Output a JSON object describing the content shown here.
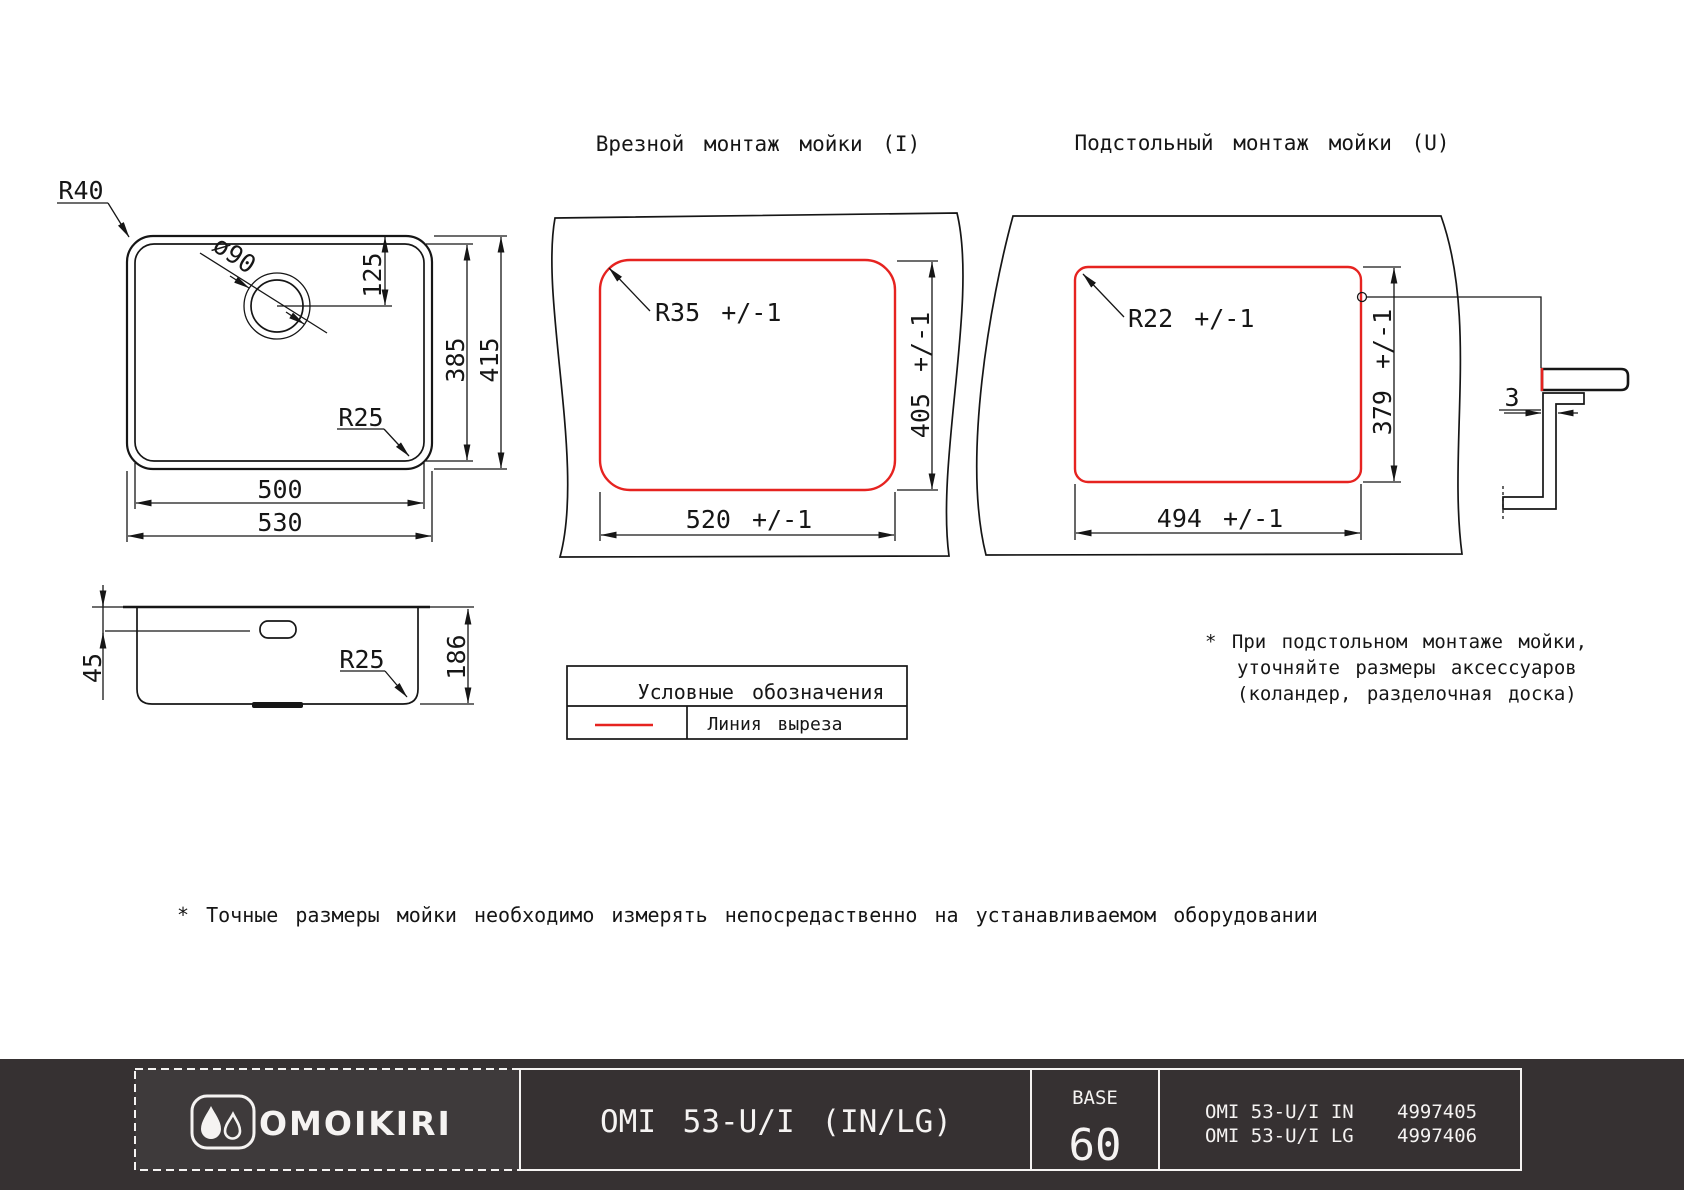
{
  "colors": {
    "cut_line_red": "#e62320",
    "drawing_line": "#161616",
    "footer_bar_bg": "#363132",
    "footer_logo_cell_bg": "#3e3a3b",
    "footer_text": "#f5f3f2"
  },
  "titles": {
    "inset_mount": "Врезной монтаж мойки (I)",
    "under_mount": "Подстольный монтаж мойки (U)"
  },
  "top_view": {
    "radius_outer": "R40",
    "drain_diameter": "ø90",
    "drain_offset": "125",
    "bowl_height": "385",
    "overall_height": "415",
    "radius_bowl": "R25",
    "bowl_width": "500",
    "overall_width": "530"
  },
  "side_view": {
    "overflow_offset": "45",
    "depth": "186",
    "bottom_radius": "R25"
  },
  "inset_view": {
    "corner_radius": "R35 +/-1",
    "cutout_height": "405 +/-1",
    "cutout_width": "520 +/-1"
  },
  "under_view": {
    "corner_radius": "R22 +/-1",
    "cutout_height": "379 +/-1",
    "cutout_width": "494 +/-1",
    "rim_gap": "3"
  },
  "legend": {
    "title": "Условные обозначения",
    "cut_line": "Линия выреза"
  },
  "notes": {
    "under_mount": [
      "* При подстольном монтаже мойки,",
      "уточняйте размеры аксессуаров",
      "(коландер, разделочная доска)"
    ],
    "measure": "* Точные размеры мойки необходимо измерять непосредаственно на устанавливаемом оборудовании"
  },
  "footer": {
    "brand": "OMOIKIRI",
    "model_title": "OMI 53-U/I (IN/LG)",
    "base_label": "BASE",
    "base_value": "60",
    "items": [
      {
        "model": "OMI 53-U/I IN",
        "code": "4997405"
      },
      {
        "model": "OMI 53-U/I LG",
        "code": "4997406"
      }
    ]
  }
}
